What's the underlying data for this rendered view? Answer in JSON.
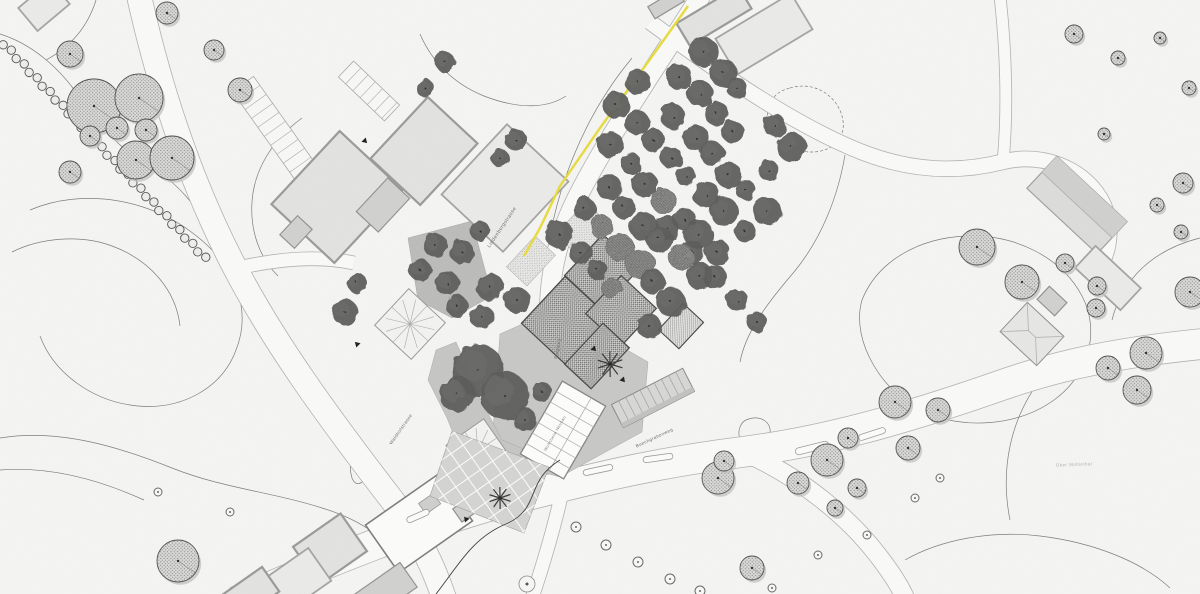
{
  "plan_title": "Situationsplan",
  "palette": {
    "bg": "#f4f4f3",
    "road_fill": "#f9f9f8",
    "road_edge": "#b2b2b1",
    "contour": "#7d7d7c",
    "contour_dark": "#3d3d3c",
    "building_fill": "#e2e2e1",
    "building_stroke": "#9b9b9a",
    "new_building_stroke": "#454544",
    "tree_dark": "#5e5e5d",
    "tree_stipple_fill": "#dcdcdb",
    "tree_stroke": "#4c4c4b",
    "accent_yellow": "#e7db3e",
    "plaza_gray": "#c8c8c7"
  },
  "labels": [
    {
      "id": "road-label-lindenbergstrasse",
      "text": "Lindenbergstrasse",
      "x": 503,
      "y": 228,
      "rot": -56,
      "size": 5,
      "color": "#6f6f6e"
    },
    {
      "id": "road-label-burgweg",
      "text": "Burgweg",
      "x": 559,
      "y": 349,
      "rot": -78,
      "size": 4.5,
      "color": "#6f6f6e"
    },
    {
      "id": "road-label-waldhofstrasse",
      "text": "Waldhofstrasse",
      "x": 402,
      "y": 430,
      "rot": -55,
      "size": 4.5,
      "color": "#6f6f6e"
    },
    {
      "id": "road-label-buechgrabenweg",
      "text": "Buechgrabenweg",
      "x": 655,
      "y": 439,
      "rot": -25,
      "size": 4.5,
      "color": "#6f6f6e"
    },
    {
      "id": "area-label-ober-muehlethal",
      "text": "Ober Mühlethal",
      "x": 1074,
      "y": 466,
      "rot": -2,
      "size": 4.5,
      "color": "#b2b2b1"
    },
    {
      "id": "building-label-wohnheim",
      "text": "Wohnheim Neubau",
      "x": 556,
      "y": 434,
      "rot": -60,
      "size": 4,
      "color": "#7a7a79"
    }
  ],
  "contours": [
    {
      "d": "M96,0 C88,26 72,46 46,60"
    },
    {
      "d": "M0,34 C32,44 60,68 80,98 C98,124 120,150 152,168 C176,182 198,206 210,234"
    },
    {
      "d": "M30,210 C82,188 148,198 194,234 C236,266 252,310 236,350 C222,388 182,410 138,406 C94,402 54,374 40,336"
    },
    {
      "d": "M12,252 C40,238 80,234 112,246 C150,260 176,290 180,326"
    },
    {
      "d": "M0,438 C60,428 122,448 172,468 C222,488 272,492 322,508 C356,518 384,536 402,560"
    },
    {
      "d": "M0,470 C50,466 100,480 144,500"
    },
    {
      "d": "M355,455 C366,450 372,460 368,472 C364,484 356,488 352,478 C349,468 350,458 355,455 Z"
    },
    {
      "d": "M862,300 C878,260 920,238 966,236 C1016,234 1062,258 1082,296 C1100,330 1090,374 1054,400 C1018,426 964,430 924,412 C884,394 850,342 862,300 Z"
    },
    {
      "d": "M790,88 C816,80 840,98 843,121 C846,142 826,156 802,151 C779,146 764,130 768,111 C771,97 778,91 790,88 Z",
      "dash": true
    },
    {
      "d": "M746,420 C760,414 772,422 770,434 C768,444 754,450 744,444 C736,438 738,424 746,420 Z"
    },
    {
      "d": "M1200,238 C1152,250 1122,280 1112,320"
    },
    {
      "d": "M302,118 C272,140 254,170 252,202 C250,232 260,258 278,276"
    },
    {
      "d": "M632,58 C602,94 578,138 562,188 C548,232 542,280 546,330"
    },
    {
      "d": "M420,34 C432,62 454,84 484,96 C520,110 548,108 566,96"
    },
    {
      "d": "M845,155 C838,196 822,238 794,272 C770,300 746,330 740,362"
    },
    {
      "d": "M905,560 C940,540 990,530 1040,536 C1090,542 1140,560 1170,588"
    },
    {
      "d": "M1040,380 C1010,420 1000,470 1010,520"
    },
    {
      "d": "M560,460 C524,482 542,508 506,524 C472,538 458,566 436,594",
      "dark": true
    }
  ],
  "roads": [
    {
      "d": "M139,-4 C160,90 190,180 232,262 C274,344 332,422 392,500 C412,526 430,556 444,598",
      "w": 24
    },
    {
      "d": "M702,-6 C662,58 612,130 579,194 C552,246 544,300 553,352 C559,398 564,430 567,468",
      "w": 19
    },
    {
      "d": "M236,602 C340,556 432,520 532,494 C602,476 662,462 742,452 C822,442 902,420 1002,385 C1062,364 1122,352 1202,344",
      "w": 30
    },
    {
      "d": "M744,452 C802,478 850,518 880,558 C892,574 900,586 906,600",
      "w": 18
    },
    {
      "d": "M650,22 C710,66 782,118 852,148 C912,174 962,172 1002,162 C1042,152 1082,168 1100,198 C1114,222 1112,252 1094,276",
      "w": 15
    },
    {
      "d": "M238,268 C282,258 322,256 354,263",
      "w": 13
    },
    {
      "d": "M1000,-4 C1006,50 1008,110 1003,162",
      "w": 11
    },
    {
      "d": "M567,468 C561,500 550,544 532,598",
      "w": 13
    }
  ],
  "yellow_line": {
    "d": "M688,6 L648,62 L600,128 L560,186 L540,228 L524,256"
  },
  "plazas": [
    {
      "pts": [
        [
          408,
          238
        ],
        [
          472,
          221
        ],
        [
          492,
          296
        ],
        [
          452,
          318
        ],
        [
          418,
          300
        ]
      ],
      "fill": "#bcbcbb"
    },
    {
      "pts": [
        [
          500,
          334
        ],
        [
          556,
          309
        ],
        [
          648,
          362
        ],
        [
          642,
          432
        ],
        [
          560,
          477
        ],
        [
          491,
          458
        ]
      ],
      "fill": "#c8c8c7"
    },
    {
      "pts": [
        [
          436,
          350
        ],
        [
          456,
          342
        ],
        [
          481,
          400
        ],
        [
          502,
          440
        ],
        [
          540,
          456
        ],
        [
          531,
          487
        ],
        [
          468,
          470
        ],
        [
          447,
          418
        ],
        [
          428,
          380
        ]
      ],
      "fill": "#c6c6c5"
    }
  ],
  "courtyard_grid": {
    "pts": [
      [
        452,
        431
      ],
      [
        549,
        467
      ],
      [
        524,
        533
      ],
      [
        430,
        496
      ]
    ],
    "fill": "#d4d4d3",
    "angle": -35,
    "step": 15
  },
  "buildings": [
    [
      337,
      197,
      100,
      86,
      -47,
      "existing"
    ],
    [
      424,
      151,
      84,
      68,
      -47,
      "existing"
    ],
    [
      505,
      188,
      96,
      84,
      -47,
      "existing-light"
    ],
    [
      383,
      205,
      46,
      30,
      -47,
      "existing-dark"
    ],
    [
      296,
      232,
      26,
      20,
      -47,
      "existing-dark"
    ],
    [
      714,
      16,
      72,
      26,
      -31,
      "existing"
    ],
    [
      764,
      34,
      88,
      42,
      -31,
      "existing-light"
    ],
    [
      666,
      4,
      34,
      14,
      -31,
      "existing-dark"
    ],
    [
      1077,
      205,
      96,
      44,
      43,
      "barn"
    ],
    [
      1108,
      278,
      62,
      30,
      43,
      "existing-light"
    ],
    [
      1032,
      334,
      50,
      40,
      43,
      "hip"
    ],
    [
      1052,
      301,
      24,
      18,
      43,
      "existing-dark"
    ],
    [
      419,
      523,
      90,
      58,
      -35,
      "white-hall"
    ],
    [
      468,
      508,
      26,
      16,
      -35,
      "existing-dark"
    ],
    [
      330,
      549,
      58,
      46,
      -35,
      "existing"
    ],
    [
      296,
      581,
      58,
      40,
      -35,
      "existing-light"
    ],
    [
      251,
      593,
      48,
      30,
      -35,
      "existing"
    ],
    [
      384,
      592,
      60,
      30,
      -35,
      "existing-dark"
    ],
    [
      44,
      6,
      42,
      30,
      -40,
      "existing-light"
    ],
    [
      563,
      430,
      84,
      50,
      -60,
      "rooms"
    ],
    [
      653,
      398,
      80,
      26,
      -27,
      "stripes"
    ],
    [
      410,
      324,
      50,
      50,
      -47,
      "fan"
    ],
    [
      478,
      451,
      46,
      46,
      -35,
      "fan"
    ]
  ],
  "new_buildings": [
    [
      602,
      272,
      56,
      50,
      -47
    ],
    [
      566,
      321,
      64,
      62,
      -47
    ],
    [
      621,
      311,
      52,
      48,
      -47
    ],
    [
      597,
      356,
      56,
      36,
      -47
    ]
  ],
  "hatch_buildings": [
    [
      681,
      326,
      36,
      28,
      -47
    ]
  ],
  "gardens": [
    [
      583,
      230,
      44,
      34,
      -47
    ],
    [
      531,
      261,
      42,
      28,
      -47
    ]
  ],
  "orchard": {
    "cx": 668,
    "cy": 180,
    "u": [
      18,
      18
    ],
    "v": [
      23,
      -23
    ],
    "rows": 8,
    "cols": 8,
    "rmin": 10,
    "rmax": 15,
    "jitter": 3
  },
  "trees_stipple": [
    [
      70,
      54,
      13
    ],
    [
      94,
      106,
      27
    ],
    [
      139,
      98,
      24
    ],
    [
      117,
      128,
      11
    ],
    [
      146,
      130,
      11
    ],
    [
      90,
      136,
      10
    ],
    [
      136,
      160,
      19
    ],
    [
      172,
      158,
      22
    ],
    [
      70,
      172,
      11
    ],
    [
      167,
      13,
      11
    ],
    [
      214,
      50,
      10
    ],
    [
      240,
      90,
      12
    ],
    [
      178,
      561,
      21
    ],
    [
      977,
      247,
      18
    ],
    [
      1022,
      282,
      17
    ],
    [
      1065,
      263,
      9
    ],
    [
      1097,
      286,
      9
    ],
    [
      1096,
      308,
      9
    ],
    [
      1183,
      183,
      10
    ],
    [
      1157,
      205,
      7
    ],
    [
      1181,
      232,
      7
    ],
    [
      1190,
      292,
      15
    ],
    [
      1146,
      353,
      16
    ],
    [
      1108,
      368,
      12
    ],
    [
      1137,
      390,
      14
    ],
    [
      895,
      402,
      16
    ],
    [
      938,
      410,
      12
    ],
    [
      848,
      438,
      10
    ],
    [
      827,
      460,
      16
    ],
    [
      908,
      448,
      12
    ],
    [
      798,
      483,
      11
    ],
    [
      857,
      488,
      9
    ],
    [
      835,
      508,
      8
    ],
    [
      752,
      568,
      12
    ],
    [
      718,
      478,
      16
    ],
    [
      724,
      461,
      10
    ],
    [
      1074,
      34,
      9
    ],
    [
      1118,
      58,
      7
    ],
    [
      1160,
      38,
      6
    ],
    [
      1189,
      88,
      7
    ],
    [
      1104,
      134,
      6
    ]
  ],
  "trees_ring": [
    [
      940,
      478,
      4
    ],
    [
      915,
      498,
      4
    ],
    [
      867,
      535,
      4
    ],
    [
      818,
      555,
      4
    ],
    [
      772,
      588,
      4
    ],
    [
      606,
      545,
      5
    ],
    [
      638,
      562,
      5
    ],
    [
      670,
      579,
      5
    ],
    [
      700,
      591,
      5
    ],
    [
      576,
      527,
      5
    ],
    [
      158,
      492,
      4
    ],
    [
      230,
      512,
      4
    ]
  ],
  "trees_dark": [
    [
      435,
      245,
      12
    ],
    [
      462,
      252,
      12
    ],
    [
      480,
      231,
      10
    ],
    [
      420,
      270,
      11
    ],
    [
      447,
      283,
      12
    ],
    [
      490,
      287,
      14
    ],
    [
      517,
      300,
      13
    ],
    [
      457,
      306,
      11
    ],
    [
      482,
      317,
      12
    ],
    [
      478,
      370,
      26
    ],
    [
      505,
      396,
      24
    ],
    [
      457,
      394,
      18
    ],
    [
      525,
      420,
      12
    ],
    [
      542,
      392,
      10
    ],
    [
      345,
      312,
      13
    ],
    [
      357,
      283,
      10
    ],
    [
      445,
      62,
      10
    ],
    [
      425,
      88,
      9
    ],
    [
      516,
      140,
      11
    ],
    [
      500,
      158,
      9
    ],
    [
      667,
      228,
      12
    ],
    [
      692,
      252,
      12
    ],
    [
      715,
      277,
      12
    ],
    [
      737,
      300,
      11
    ],
    [
      757,
      322,
      10
    ]
  ],
  "palms": [
    [
      610,
      364,
      13
    ],
    [
      500,
      498,
      11
    ]
  ],
  "hedge": {
    "x1": 4,
    "y1": 44,
    "x2": 205,
    "y2": 258,
    "r": 4.2,
    "n": 32
  },
  "parking_ladders": [
    {
      "x1": 243,
      "y1": 84,
      "x2": 341,
      "y2": 222,
      "w": 26,
      "step": 11
    },
    {
      "x1": 346,
      "y1": 69,
      "x2": 392,
      "y2": 113,
      "w": 22,
      "step": 10
    }
  ],
  "islands": [
    [
      598,
      470,
      30,
      6,
      -12
    ],
    [
      658,
      458,
      30,
      6,
      -8
    ],
    [
      812,
      448,
      34,
      7,
      -14
    ],
    [
      418,
      516,
      24,
      6,
      -24
    ],
    [
      872,
      434,
      28,
      6,
      -18
    ]
  ],
  "roundabout": {
    "x": 527,
    "y": 584,
    "r": 8
  },
  "markers": [
    [
      365,
      141,
      135
    ],
    [
      357,
      344,
      -45
    ],
    [
      594,
      349,
      135
    ],
    [
      466,
      519,
      -40
    ],
    [
      623,
      380,
      140
    ]
  ]
}
